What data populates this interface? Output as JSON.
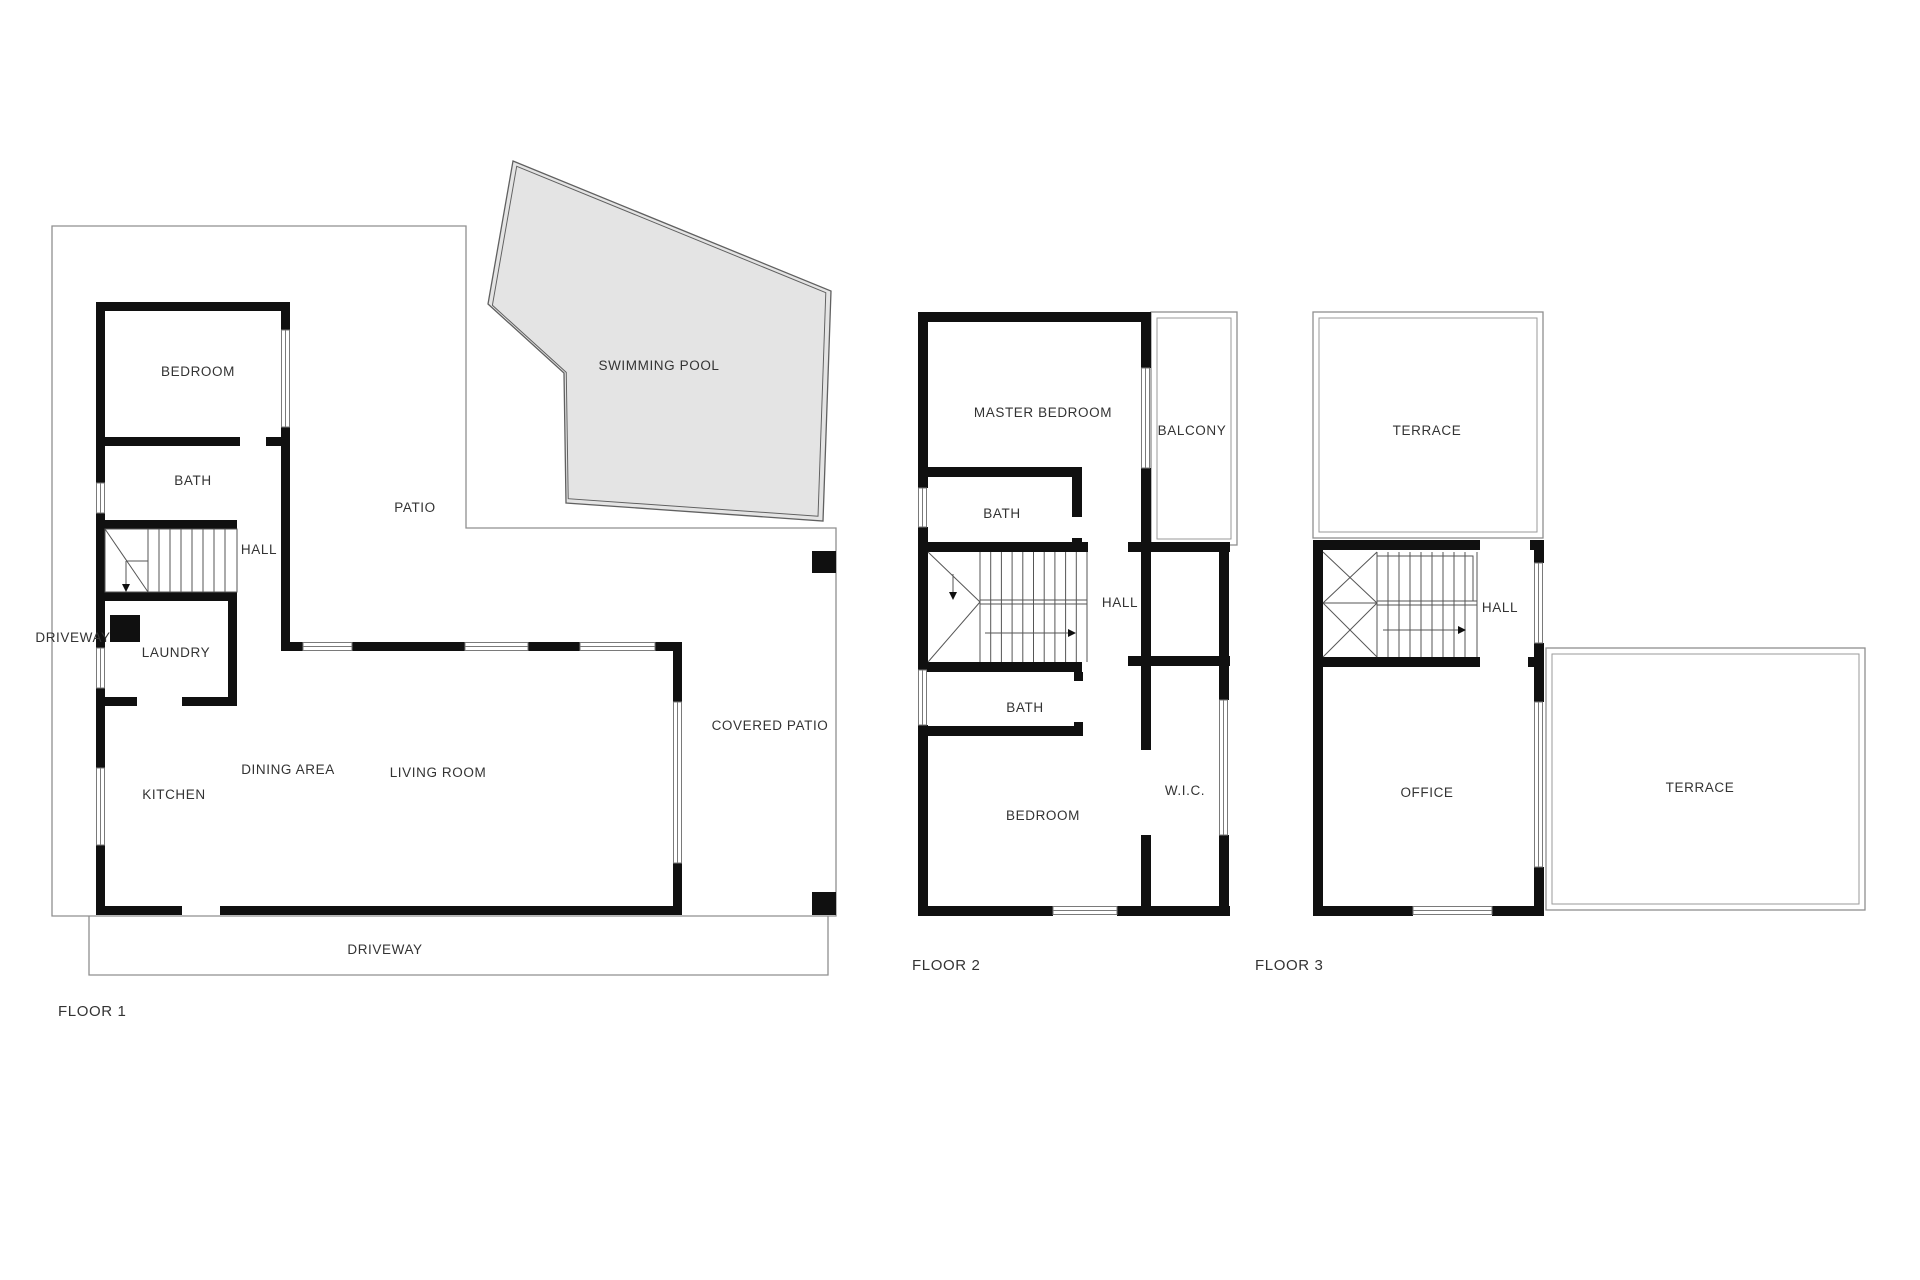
{
  "document": {
    "type": "residential floor plan drawing",
    "floors_count": 3
  },
  "colors": {
    "background": "#ffffff",
    "wall": "#101010",
    "boundary_line": "#8f8f8f",
    "pool_fill": "#e4e4e4",
    "pool_stroke": "#606060",
    "stair_line": "#565656",
    "label_text": "#333333"
  },
  "floors": [
    {
      "name": "FLOOR 1",
      "rooms": [
        {
          "id": "bedroom",
          "label": "BEDROOM"
        },
        {
          "id": "bath",
          "label": "BATH"
        },
        {
          "id": "hall",
          "label": "HALL"
        },
        {
          "id": "driveway-side",
          "label": "DRIVEWAY"
        },
        {
          "id": "laundry",
          "label": "LAUNDRY"
        },
        {
          "id": "kitchen",
          "label": "KITCHEN"
        },
        {
          "id": "dining-area",
          "label": "DINING AREA"
        },
        {
          "id": "living-room",
          "label": "LIVING ROOM"
        },
        {
          "id": "patio",
          "label": "PATIO"
        },
        {
          "id": "swimming-pool",
          "label": "SWIMMING POOL"
        },
        {
          "id": "covered-patio",
          "label": "COVERED PATIO"
        },
        {
          "id": "driveway-bottom",
          "label": "DRIVEWAY"
        }
      ]
    },
    {
      "name": "FLOOR 2",
      "rooms": [
        {
          "id": "master-bedroom",
          "label": "MASTER BEDROOM"
        },
        {
          "id": "balcony",
          "label": "BALCONY"
        },
        {
          "id": "bath-upper",
          "label": "BATH"
        },
        {
          "id": "hall",
          "label": "HALL"
        },
        {
          "id": "bath-lower",
          "label": "BATH"
        },
        {
          "id": "bedroom",
          "label": "BEDROOM"
        },
        {
          "id": "walk-in-closet",
          "label": "W.I.C."
        }
      ]
    },
    {
      "name": "FLOOR 3",
      "rooms": [
        {
          "id": "terrace-top",
          "label": "TERRACE"
        },
        {
          "id": "hall",
          "label": "HALL"
        },
        {
          "id": "office",
          "label": "OFFICE"
        },
        {
          "id": "terrace-right",
          "label": "TERRACE"
        }
      ]
    }
  ]
}
